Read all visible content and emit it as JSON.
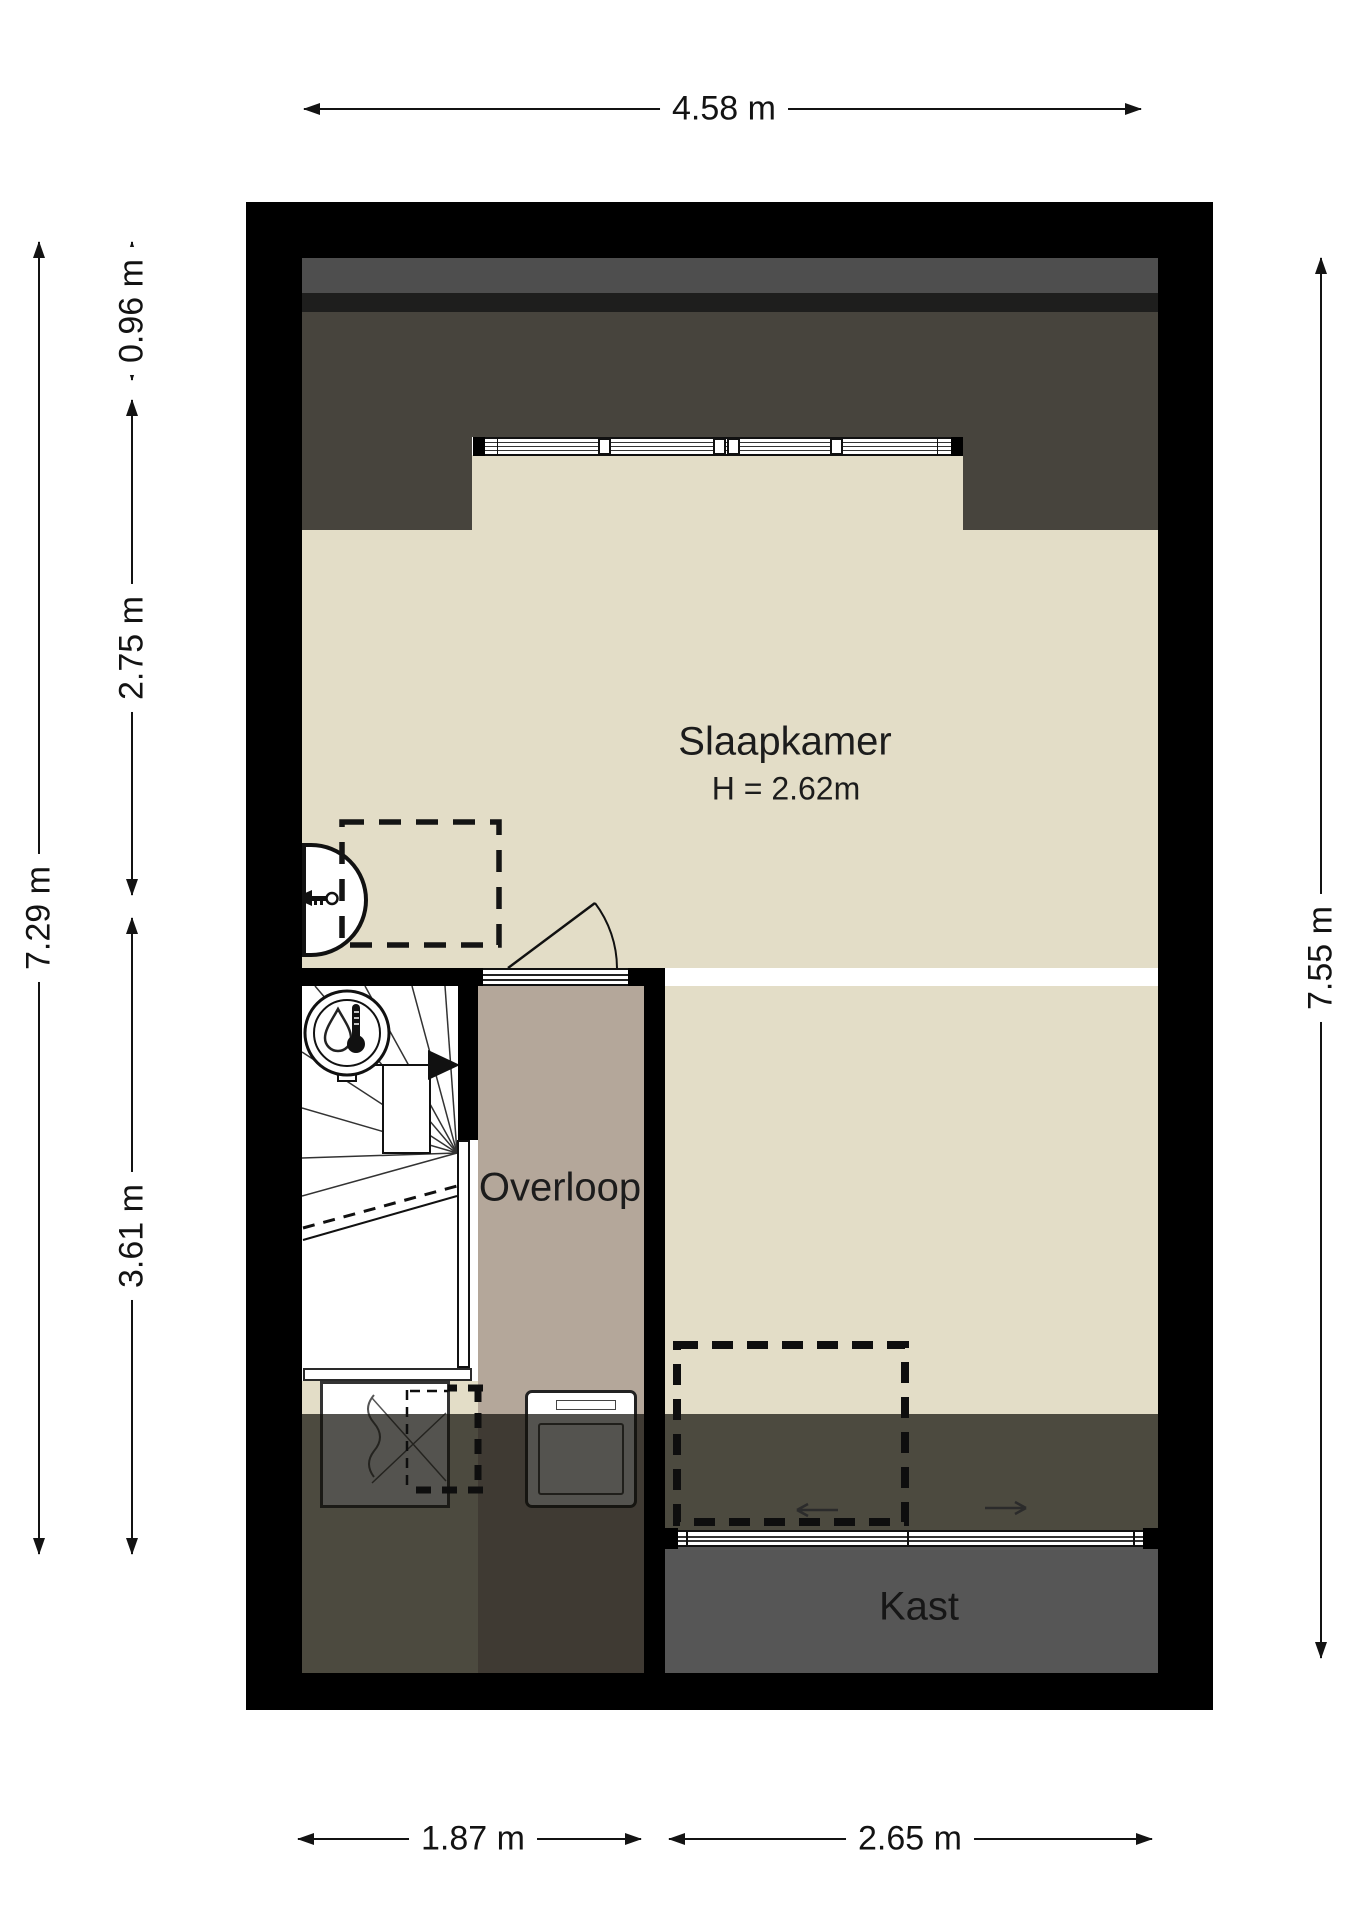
{
  "rooms": {
    "slaapkamer": {
      "label": "Slaapkamer",
      "height_label": "H = 2.62m"
    },
    "overloop": {
      "label": "Overloop"
    },
    "kast": {
      "label": "Kast"
    }
  },
  "dimensions": {
    "top": "4.58 m",
    "left_total": "7.29 m",
    "left_segments": [
      "0.96 m",
      "2.75 m",
      "3.61 m"
    ],
    "right_total": "7.55 m",
    "bottom_segments": [
      "1.87 m",
      "2.65 m"
    ]
  },
  "colors": {
    "wall": "#000000",
    "bedroom_floor": "#e3ddc7",
    "landing_floor": "#b4a79a",
    "sloped_roof_dark": "#47443d",
    "top_band_gray": "#4e4e4e",
    "closet_floor": "#565656",
    "stairs": "#ffffff"
  }
}
